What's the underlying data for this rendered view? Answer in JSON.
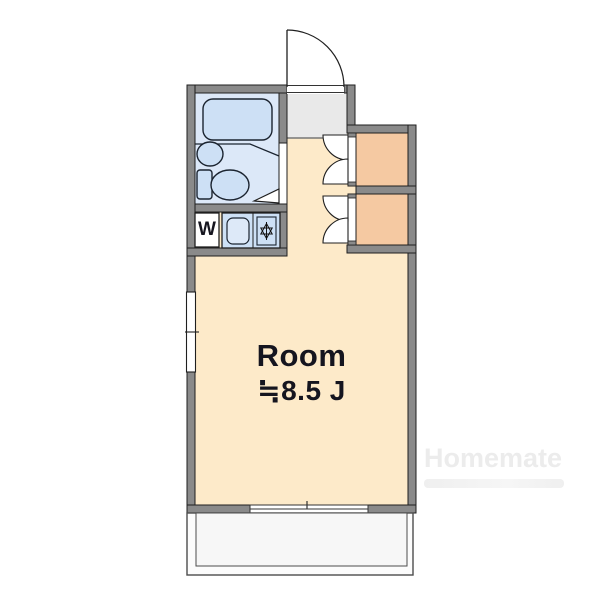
{
  "floorplan": {
    "room": {
      "label": "Room",
      "size": "≒8.5 J"
    },
    "fixtures": {
      "washer_label": "W"
    },
    "icons": {
      "stove": "six-point-star-icon",
      "entrance_door": "quarter-arc-swing",
      "closet_doors": "double-swing-arcs"
    },
    "watermark": {
      "brand": "Homemate"
    },
    "colors": {
      "wall": "#8a8a8a",
      "wall_outline": "#1f1f1f",
      "room_floor": "#fdeac9",
      "closet_floor": "#f5c9a2",
      "bath_floor": "#dce8f8",
      "bath_fixture": "#cde0f5",
      "entrance_floor": "#e9e9e9",
      "balcony_floor": "#f7f7f7",
      "counter": "#cde0f5"
    }
  }
}
